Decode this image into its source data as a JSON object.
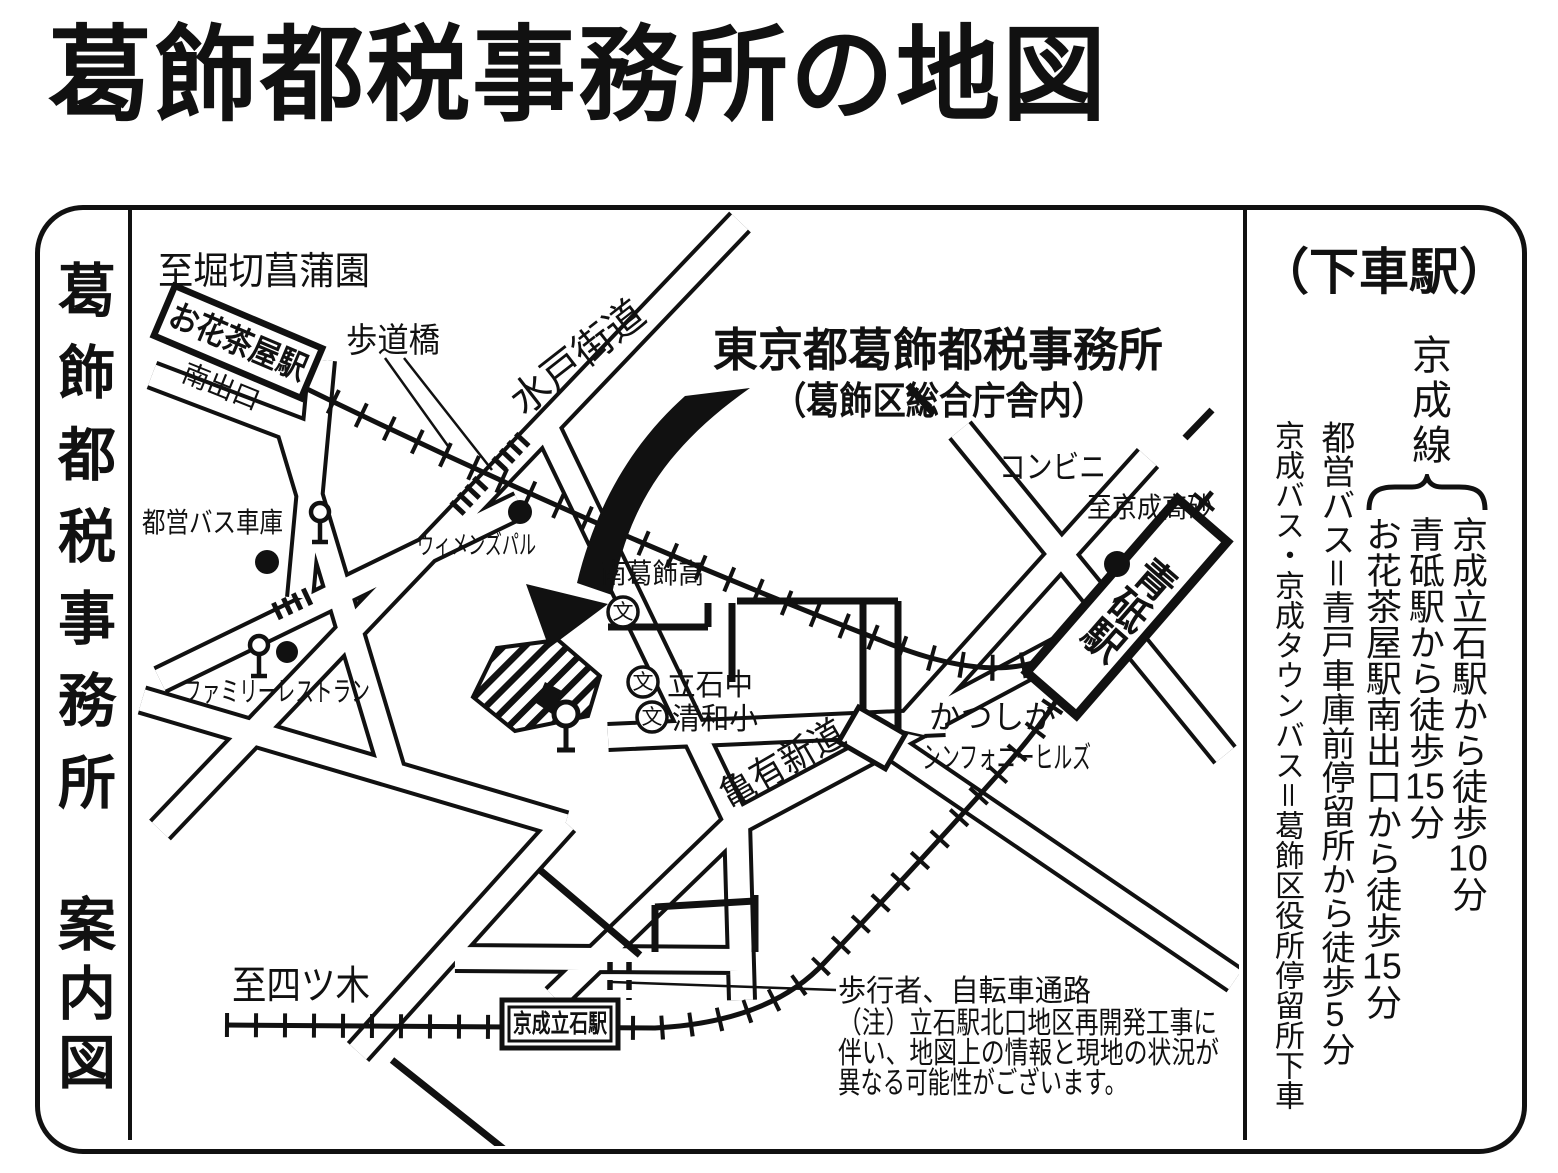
{
  "title": "葛飾都税事務所の地図",
  "left_panel": {
    "office_name": "葛飾都税事務所",
    "guide": "案内図"
  },
  "right_panel": {
    "header": "（下車駅）",
    "line_name": "京成線",
    "walk_routes": [
      {
        "pre": "京成立石駅から徒歩",
        "num": "10",
        "post": "分"
      },
      {
        "pre": "青砥駅から徒歩",
        "num": "15",
        "post": "分"
      },
      {
        "pre": "お花茶屋駅南出口から徒歩",
        "num": "15",
        "post": "分"
      }
    ],
    "bus_routes": [
      {
        "pre": "都営バス＝青戸車庫前停留所から徒歩",
        "num": "5",
        "post": "分"
      },
      {
        "pre": "京成バス・京成タウンバス＝葛飾区役所停留所下車",
        "num": "",
        "post": ""
      }
    ]
  },
  "map": {
    "office_callout": {
      "line1": "東京都葛飾都税事務所",
      "line2": "（葛飾区総合庁舎内）"
    },
    "stations": {
      "ohanajaya": "お花茶屋駅",
      "south_exit": "南出口",
      "aoto": "青砥駅",
      "keisei_tateishi": "京成立石駅"
    },
    "roads": {
      "mito_kaido": "水戸街道",
      "kameari_shindo": "亀有新道"
    },
    "directions": {
      "to_horikiri": "至堀切菖蒲園",
      "to_takasago": "至京成高砂",
      "to_yotsugi": "至四ツ木"
    },
    "landmarks": {
      "pedestrian_bridge": "歩道橋",
      "bus_depot": "都営バス車庫",
      "womens_pal": "ウィメンズパル",
      "family_restaurant": "ファミリーレストラン",
      "convenience_store": "コンビニ",
      "symphony_hills_1": "かつしか",
      "symphony_hills_2": "シンフォニーヒルズ"
    },
    "schools": {
      "mark": "文",
      "minami_katsushika_high": "南葛飾高",
      "tateishi_junior_high": "立石中",
      "seiwa_elementary": "清和小"
    },
    "notes": {
      "passage": "歩行者、自転車通路",
      "caution1": "（注）立石駅北口地区再開発工事に",
      "caution2": "伴い、地図上の情報と現地の状況が",
      "caution3": "異なる可能性がございます。"
    }
  },
  "colors": {
    "ink": "#111111",
    "paper": "#ffffff"
  }
}
